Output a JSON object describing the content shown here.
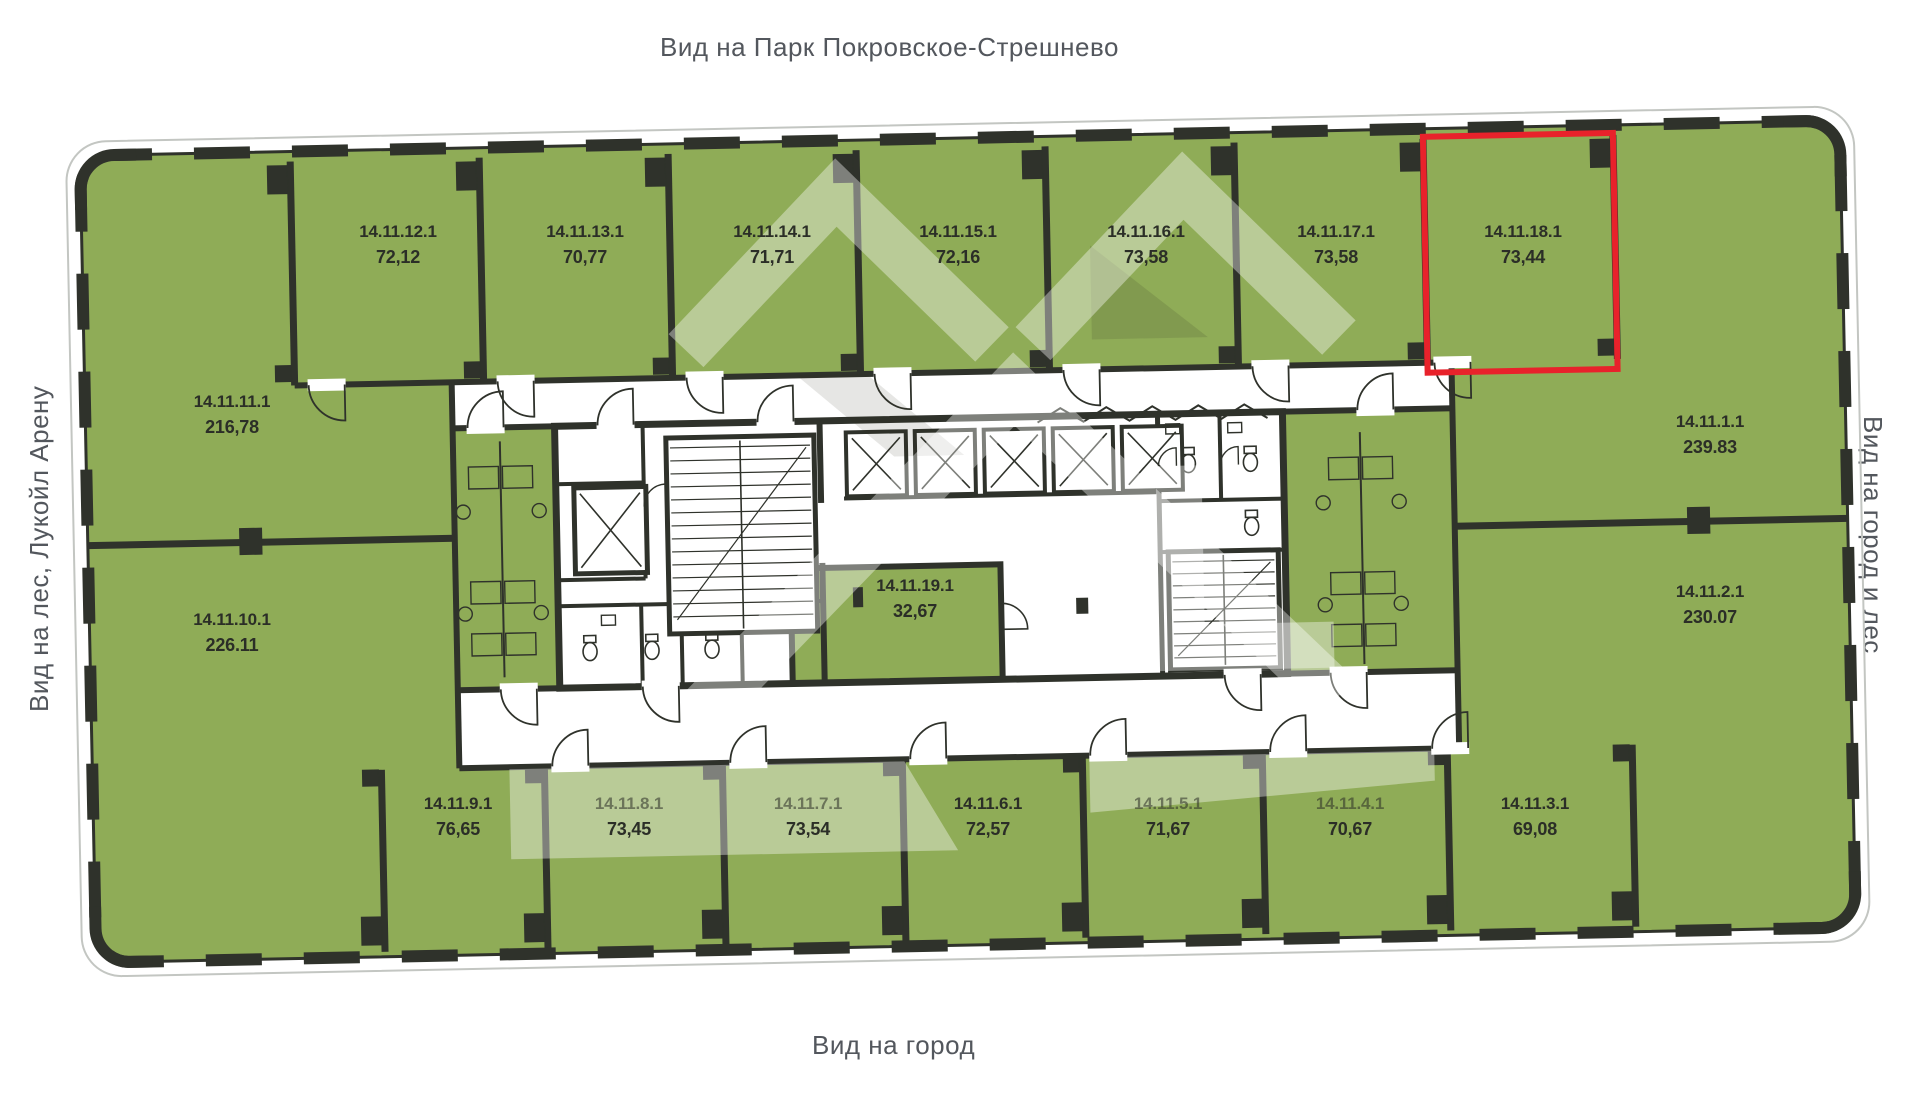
{
  "page": {
    "title_top": "Вид на Парк Покровское-Стрешнево",
    "label_left": "Вид на лес, Лукойл Арену",
    "label_right": "Вид на город и лес",
    "label_bottom": "Вид на город"
  },
  "floor_plan": {
    "highlighted_unit": "14.11.18.1",
    "colors": {
      "unit_fill": "#8fac57",
      "wall": "#2f322b",
      "highlight": "#e8222b",
      "label_text": "#2b2e27",
      "outside_text": "#53575d",
      "watermark": "rgba(255,255,255,0.38)"
    },
    "units": [
      {
        "id": "14.11.12.1",
        "area": "72,12"
      },
      {
        "id": "14.11.13.1",
        "area": "70,77"
      },
      {
        "id": "14.11.14.1",
        "area": "71,71"
      },
      {
        "id": "14.11.15.1",
        "area": "72,16"
      },
      {
        "id": "14.11.16.1",
        "area": "73,58"
      },
      {
        "id": "14.11.17.1",
        "area": "73,58"
      },
      {
        "id": "14.11.18.1",
        "area": "73,44"
      },
      {
        "id": "14.11.11.1",
        "area": "216,78"
      },
      {
        "id": "14.11.10.1",
        "area": "226.11"
      },
      {
        "id": "14.11.1.1",
        "area": "239.83"
      },
      {
        "id": "14.11.2.1",
        "area": "230.07"
      },
      {
        "id": "14.11.9.1",
        "area": "76,65"
      },
      {
        "id": "14.11.8.1",
        "area": "73,45"
      },
      {
        "id": "14.11.7.1",
        "area": "73,54"
      },
      {
        "id": "14.11.6.1",
        "area": "72,57"
      },
      {
        "id": "14.11.5.1",
        "area": "71,67"
      },
      {
        "id": "14.11.4.1",
        "area": "70,67"
      },
      {
        "id": "14.11.3.1",
        "area": "69,08"
      },
      {
        "id": "14.11.19.1",
        "area": "32,67"
      }
    ]
  }
}
